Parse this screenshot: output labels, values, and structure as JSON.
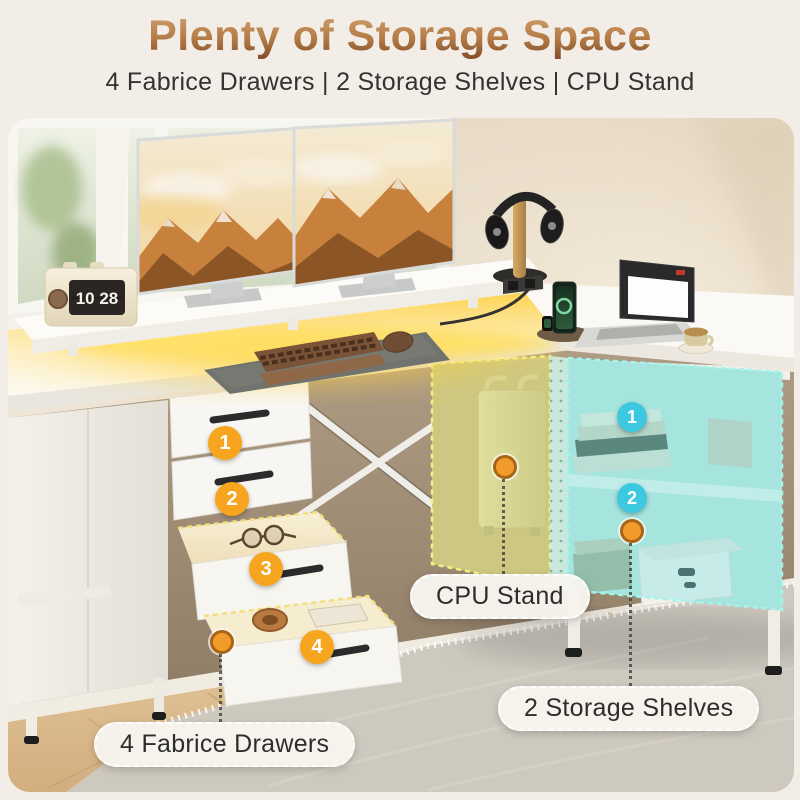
{
  "header": {
    "title": "Plenty of Storage Space",
    "subtitle": "4 Fabrice Drawers | 2 Storage Shelves | CPU Stand"
  },
  "scene": {
    "clock_time": "10 28",
    "drawer_badges": [
      "1",
      "2",
      "3",
      "4"
    ],
    "shelf_badges": [
      "1",
      "2"
    ],
    "callouts": {
      "cpu_stand": "CPU Stand",
      "storage_shelves": "2 Storage Shelves",
      "fabric_drawers": "4 Fabrice Drawers"
    }
  },
  "colors": {
    "title_gradient_top": "#C89B6E",
    "title_gradient_bottom": "#7C4A28",
    "badge_orange": "#F7A51F",
    "badge_cyan": "#3CC9DF",
    "highlight_yellow": "#E3E582",
    "highlight_cyan": "#82E4E6",
    "led_glow": "#FFD23E"
  }
}
